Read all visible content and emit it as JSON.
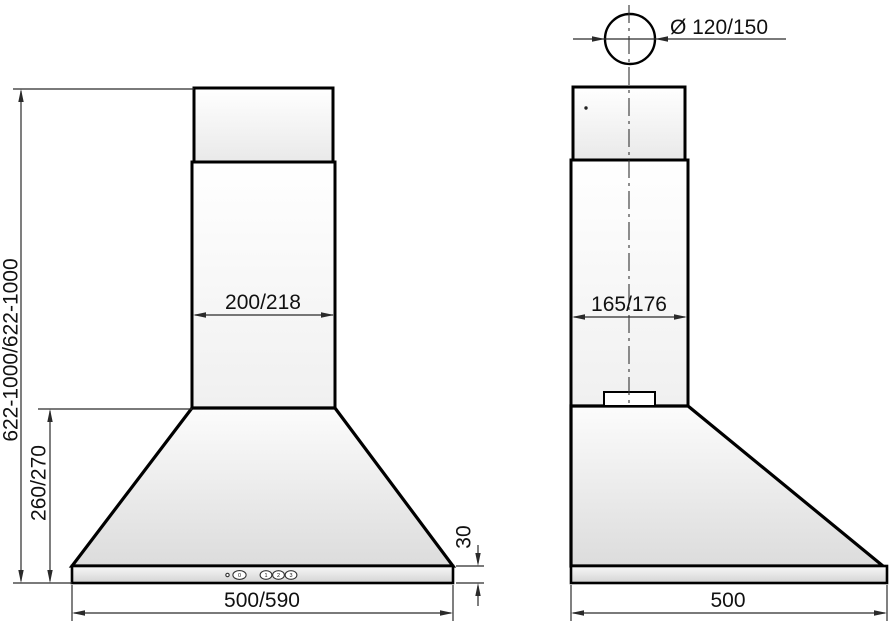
{
  "figure": {
    "type": "technical dimension drawing",
    "product": "chimney cooker hood",
    "front_view": {
      "chimney_width": "200/218",
      "overall_height": "622-1000/622-1000",
      "canopy_height": "260/270",
      "body_width": "500/590",
      "panel_height": "30",
      "control_buttons": [
        "0",
        "1",
        "2",
        "3"
      ]
    },
    "side_view": {
      "duct_diameter": "Ø 120/150",
      "chimney_depth": "165/176",
      "body_depth": "500"
    },
    "colors": {
      "outline": "#000000",
      "dimension_line": "#2a2a2a",
      "background": "#ffffff"
    }
  }
}
